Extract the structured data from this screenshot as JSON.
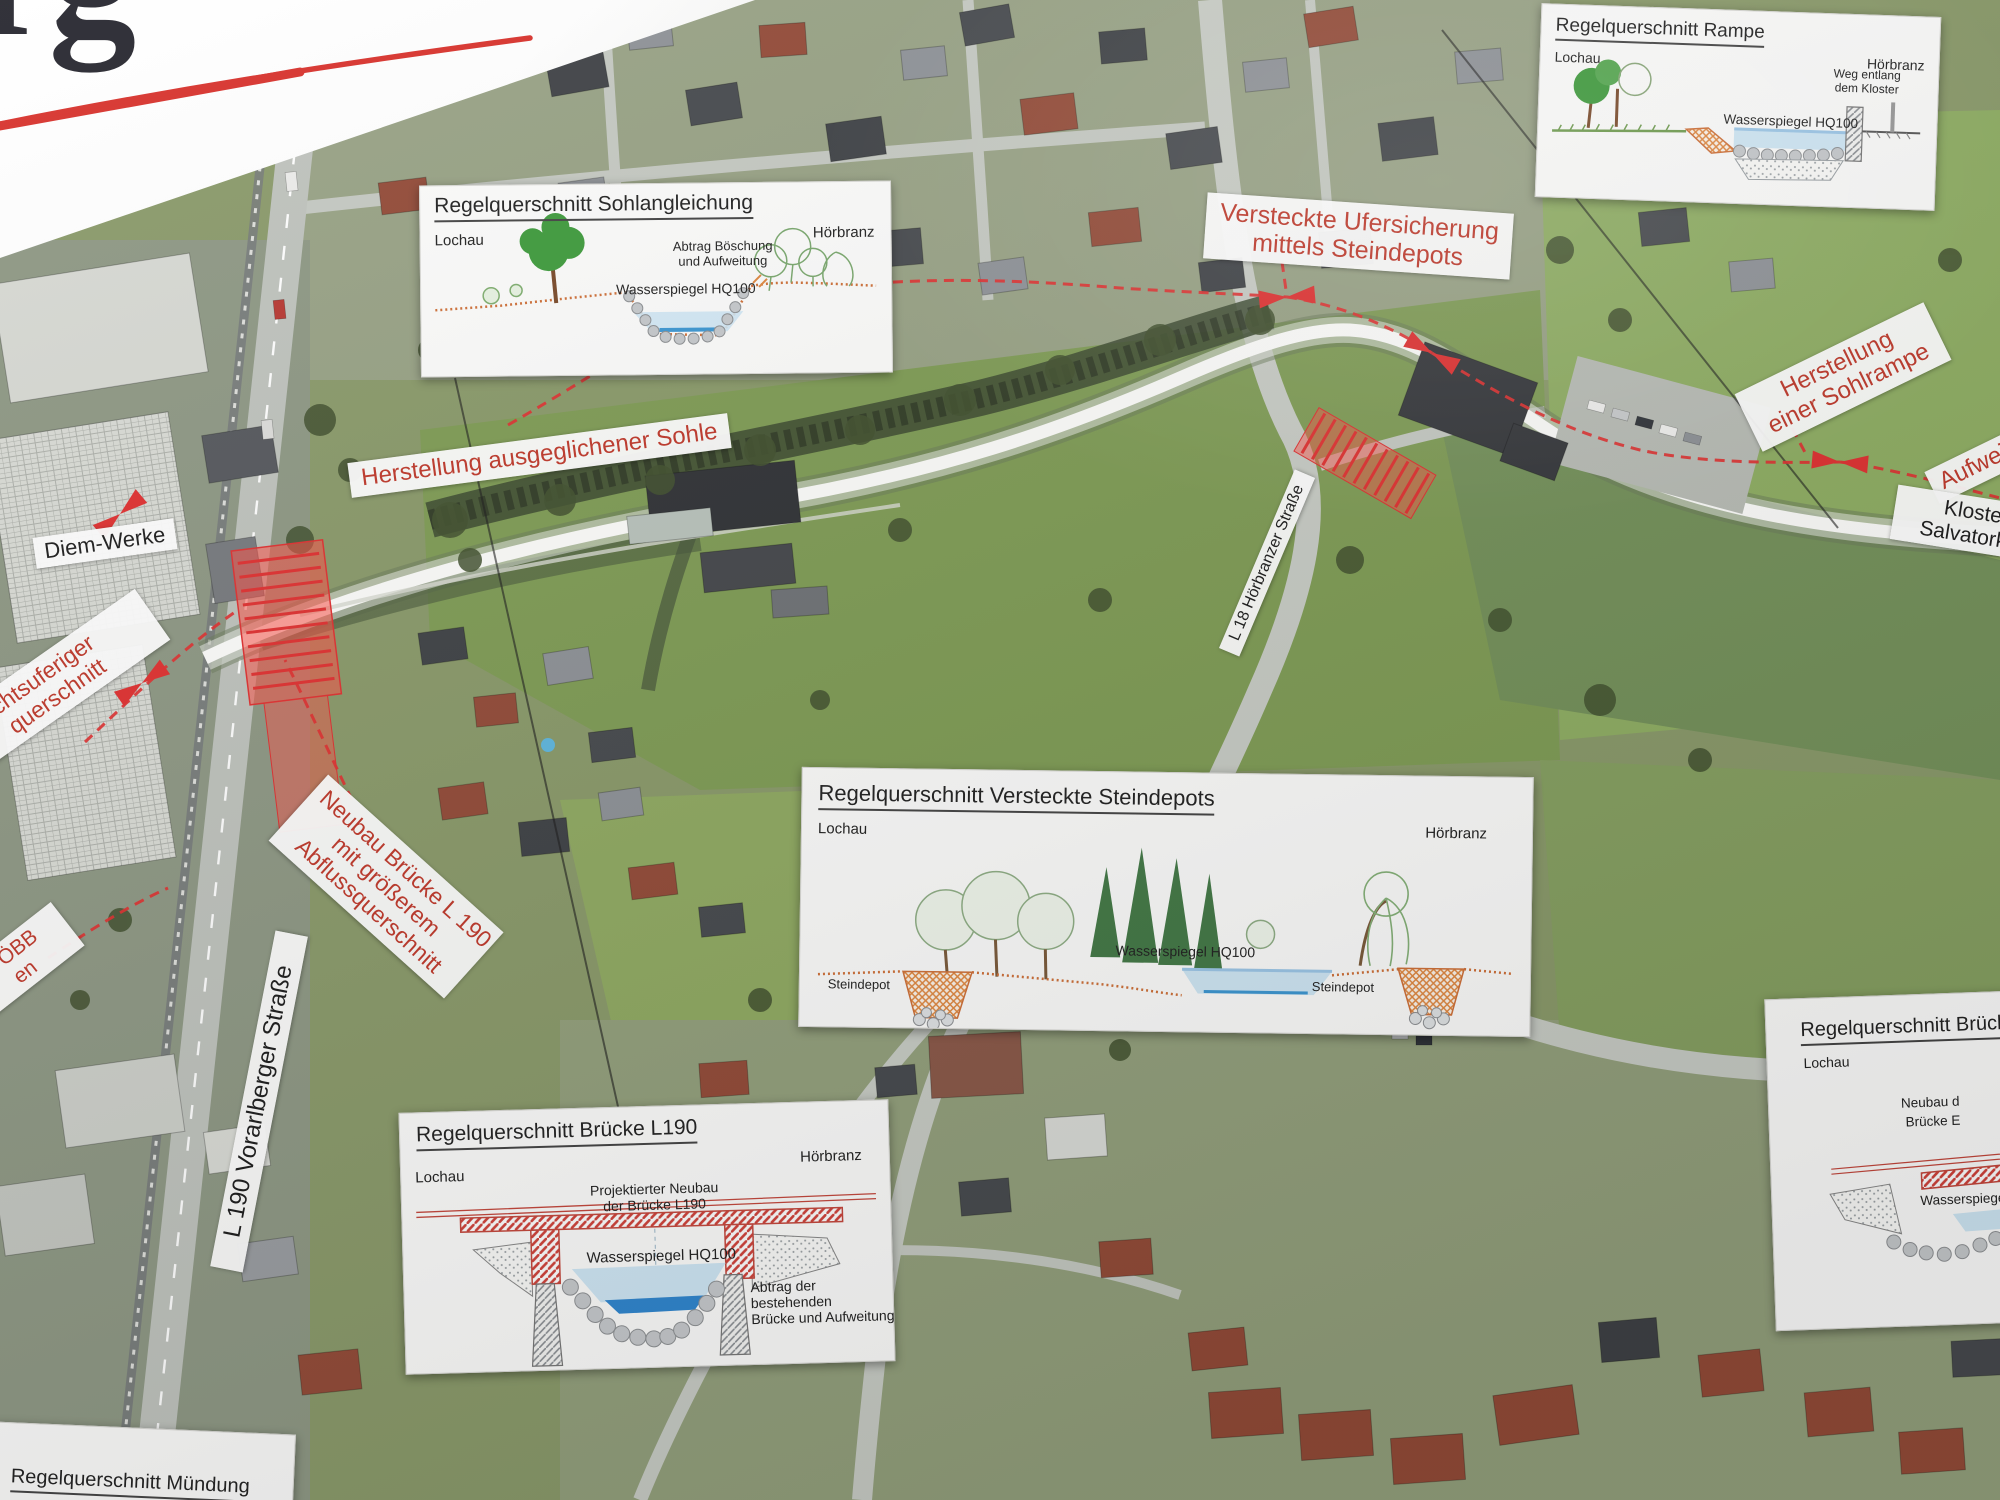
{
  "banner": {
    "logo_text": "rg"
  },
  "insets": {
    "sohlangleichung": {
      "title": "Regelquerschnitt Sohlangleichung",
      "left_label": "Lochau",
      "right_label": "Hörbranz",
      "note_line1": "Abtrag Böschung",
      "note_line2": "und Aufweitung",
      "water_label": "Wasserspiegel HQ100"
    },
    "rampe": {
      "title": "Regelquerschnitt Rampe",
      "left_label": "Lochau",
      "right_label": "Hörbranz",
      "note_line1": "Weg entlang",
      "note_line2": "dem Kloster",
      "water_label": "Wasserspiegel HQ100"
    },
    "steindepots": {
      "title": "Regelquerschnitt Versteckte Steindepots",
      "left_label": "Lochau",
      "right_label": "Hörbranz",
      "water_label": "Wasserspiegel HQ100",
      "depot_left": "Steindepot",
      "depot_right": "Steindepot"
    },
    "bruecke_l190": {
      "title": "Regelquerschnitt Brücke L190",
      "left_label": "Lochau",
      "right_label": "Hörbranz",
      "note_top_line1": "Projektierter Neubau",
      "note_top_line2": "der Brücke L190",
      "water_label": "Wasserspiegel HQ100",
      "note_right_line1": "Abtrag der bestehenden",
      "note_right_line2": "Brücke und Aufweitung"
    },
    "bruecke_partial": {
      "title": "Regelquerschnitt Brücke",
      "left_label": "Lochau",
      "note_line1": "Neubau d",
      "note_line2": "Brücke E",
      "water_label": "Wasserspiegel"
    },
    "muendung": {
      "title": "Regelquerschnitt Mündung"
    }
  },
  "red_annotations": {
    "versteckte": {
      "line1": "Versteckte Ufersicherung",
      "line2": "mittels Steindepots"
    },
    "ausgeglichene_sohle": {
      "line1": "Herstellung ausgeglichener Sohle"
    },
    "sohlrampe": {
      "line1": "Herstellung",
      "line2": "einer Sohlrampe"
    },
    "aufweitung": {
      "line1": "Aufweitung"
    },
    "neubau_bruecke": {
      "line1": "Neubau Brücke L 190",
      "line2": "mit größerem",
      "line3": "Abflussquerschnitt"
    },
    "rechtsufrig": {
      "line1": "chtsuferiger",
      "line2": "querschnitt"
    },
    "oebb": {
      "line1": "e ÖBB",
      "line2": "en"
    }
  },
  "place_labels": {
    "diem_werke": "Diem-Werke",
    "kloster_line1": "Kloster -",
    "kloster_line2": "Salvatorkolle",
    "l190": "L 190 Vorarlberger Straße",
    "l18": "L 18 Hörbranzer Straße",
    "lochau": "Lochau"
  },
  "colors": {
    "annotation_red": "#c0392b",
    "highlight_red": "#e03131",
    "water_blue": "#cfe7f5",
    "terrain_orange": "#cf7038"
  }
}
